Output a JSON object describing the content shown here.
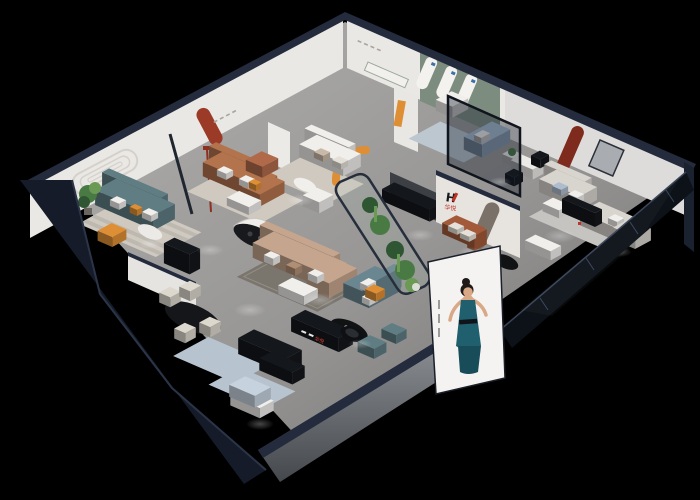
{
  "scene": {
    "type": "3d-isometric-showroom-render",
    "background": "#000000",
    "brand": {
      "monogram": "H",
      "name": "华悦",
      "accent_red": "#c03126",
      "mark_dark": "#16181b"
    },
    "palette": {
      "wall_white": "#eae8e4",
      "wall_grey": "#dddcda",
      "wall_green": "#7c8d80",
      "wall_cap": "#232b3d",
      "exterior_dark": "#151b28",
      "facade_grey": "#7d8086",
      "glass_tint": "#0d1118",
      "rug_cream": "#cfc9c0",
      "rug_stripe": "#bdb9b1",
      "rug_blue": "#b7c4d0",
      "rug_dark": "#7a756d",
      "rug_grey": "#c6c4c0",
      "rug_lightblue": "#bcc7cf",
      "sofa_caramel": "#b3734d",
      "sofa_teal": "#5f7d83",
      "sofa_tan": "#c5a58d",
      "sofa_slate": "#6a8691",
      "sofa_lightblue": "#a8bdd4",
      "sofa_greige": "#d8d4ce",
      "sofa_rust": "#a35a3a",
      "sofa_paleblue": "#c6d2de",
      "accent_orange": "#de8f35",
      "accent_red_niche": "#9c3a28",
      "furniture_black": "#14171b",
      "furniture_white": "#f0efec",
      "chair_cream": "#ddd8ce",
      "plant_green": "#4a7a44",
      "plant_dark": "#2f5633",
      "plant_light": "#6b9a55",
      "poster_bg": "#f4f3f1",
      "poster_dress": "#1f5f6e",
      "poster_skin": "#d9a887",
      "poster_hair": "#1f1a17"
    }
  }
}
